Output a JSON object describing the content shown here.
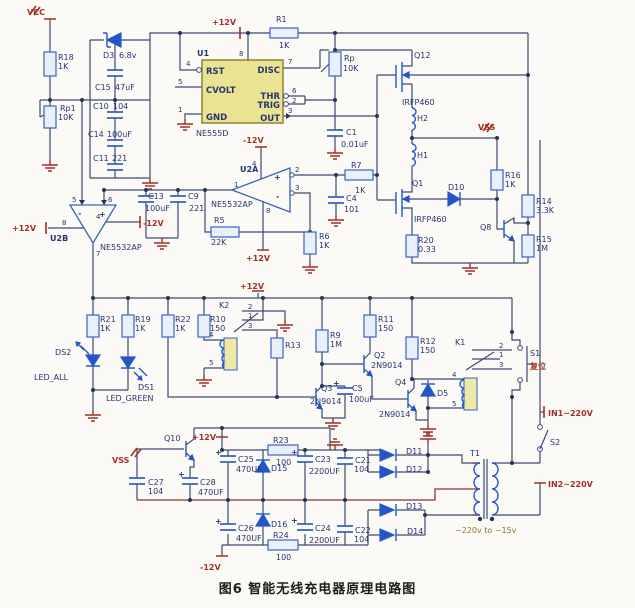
{
  "caption": "图6  智能无线充电器原理电路图",
  "power": {
    "vcc": "VCC",
    "p12": "+12V",
    "n12": "-12V",
    "vss": "VSS",
    "in1": "IN1~220V",
    "in2": "IN2~220V",
    "ratio": "~220v to ~15v",
    "reset": "复位"
  },
  "pins": {
    "n1": "1",
    "n2": "2",
    "n3": "3",
    "n4": "4",
    "n5": "5",
    "n6": "6",
    "n7": "7",
    "n8": "8"
  },
  "sym": {
    "plus": "+",
    "minus": "-"
  },
  "u1": {
    "ref": "U1",
    "part": "NE555D",
    "rst": "RST",
    "cvolt": "CVOLT",
    "gnd": "GND",
    "disc": "DISC",
    "thr": "THR",
    "trig": "TRIG",
    "out": "OUT"
  },
  "u2": {
    "a": "U2A",
    "b": "U2B",
    "part": "NE5532AP"
  },
  "refs": {
    "r1": "R1",
    "r5": "R5",
    "r6": "R6",
    "r7": "R7",
    "r9": "R9",
    "r10": "R10",
    "r11": "R11",
    "r12": "R12",
    "r13": "R13",
    "r14": "R14",
    "r15": "R15",
    "r16": "R16",
    "r18": "R18",
    "r19": "R19",
    "r20": "R20",
    "r21": "R21",
    "r22": "R22",
    "r23": "R23",
    "r24": "R24",
    "rp": "Rp",
    "rp1": "Rp1",
    "c1": "C1",
    "c4": "C4",
    "c5": "C5",
    "c9": "C9",
    "c10": "C10",
    "c11": "C11",
    "c13": "C13",
    "c14": "C14",
    "c15": "C15",
    "c21": "C21",
    "c22": "C22",
    "c23": "C23",
    "c24": "C24",
    "c25": "C25",
    "c26": "C26",
    "c27": "C27",
    "c28": "C28",
    "d3": "D3",
    "d5": "D5",
    "d10": "D10",
    "d11": "D11",
    "d12": "D12",
    "d13": "D13",
    "d14": "D14",
    "d15": "D15",
    "d16": "D16",
    "ds1": "DS1",
    "ds2": "DS2",
    "led_all": "LED_ALL",
    "led_green": "LED_GREEN",
    "h1": "H1",
    "h2": "H2",
    "q1": "Q1",
    "q2": "Q2",
    "q3": "Q3",
    "q4": "Q4",
    "q8": "Q8",
    "q10": "Q10",
    "q12": "Q12",
    "k1": "K1",
    "k2": "K2",
    "s1": "S1",
    "s2": "S2",
    "t1": "T1"
  },
  "vals": {
    "k1": "1K",
    "k10": "10K",
    "k22": "22K",
    "k33": "3.3K",
    "m1": "1M",
    "r150": "150",
    "r100": "100",
    "r033": "0.33",
    "c104": "104",
    "c221": "221",
    "c101": "101",
    "c47u": "47uF",
    "c100u": "100uF",
    "c470u": "470UF",
    "c2200u": "2200UF",
    "c001": "0.01uF",
    "d68": "6.8v",
    "q9014": "2N9014",
    "irfp": "IRFP460"
  }
}
